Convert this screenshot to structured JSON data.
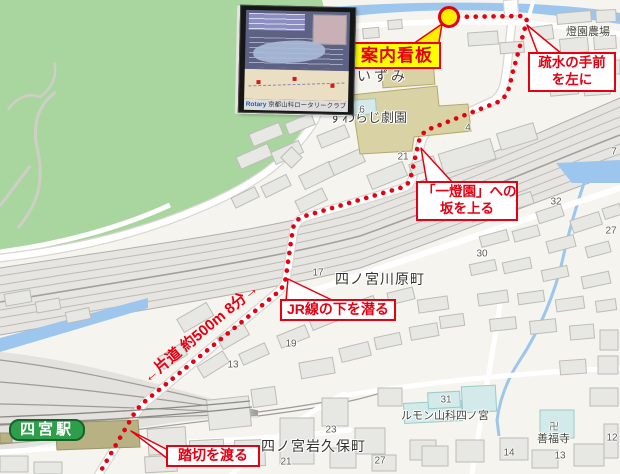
{
  "map": {
    "callouts": {
      "annai_kanban": "案内看板",
      "sosui_line1": "疏水の手前",
      "sosui_line2": "を左に",
      "itoen_line1": "「一燈園」への",
      "itoen_line2": "坂を上る",
      "jr_underpass": "JR線の下を潜る",
      "fumikiri": "踏切を渡る",
      "distance": "←片道 約500m 8分→"
    },
    "station": {
      "name": "四宮駅"
    },
    "places": {
      "izumi": "いずみ",
      "suwaraji": "すわらじ劇園",
      "kawaramachi": "四ノ宮川原町",
      "iwakubocho": "四ノ宮岩久保町",
      "lumon": "ルモン山科四ノ宮",
      "zenpukuji": "善福寺",
      "temple_mark": "卍",
      "toen_farm": "燈園農場"
    },
    "house_numbers": [
      {
        "v": "6",
        "x": 362,
        "y": 110
      },
      {
        "v": "21",
        "x": 403,
        "y": 157
      },
      {
        "v": "4",
        "x": 468,
        "y": 128
      },
      {
        "v": "7",
        "x": 614,
        "y": 152
      },
      {
        "v": "32",
        "x": 556,
        "y": 202
      },
      {
        "v": "27",
        "x": 611,
        "y": 231
      },
      {
        "v": "30",
        "x": 482,
        "y": 254
      },
      {
        "v": "17",
        "x": 318,
        "y": 273
      },
      {
        "v": "19",
        "x": 291,
        "y": 344
      },
      {
        "v": "13",
        "x": 233,
        "y": 365
      },
      {
        "v": "21",
        "x": 286,
        "y": 462
      },
      {
        "v": "23",
        "x": 331,
        "y": 430
      },
      {
        "v": "27",
        "x": 380,
        "y": 461
      },
      {
        "v": "31",
        "x": 446,
        "y": 400
      },
      {
        "v": "14",
        "x": 509,
        "y": 453
      },
      {
        "v": "13",
        "x": 560,
        "y": 456
      },
      {
        "v": "12",
        "x": 612,
        "y": 438
      }
    ],
    "inset": {
      "caption_logo": "Rotary",
      "caption_text": " 京都山科ロータリークラブ"
    },
    "colors": {
      "route_red": "#e60012",
      "marker_yellow": "#ffee00",
      "label_yellow": "#ffff00",
      "station_green": "#2f9e4b",
      "park_green": "#a9d69f",
      "water_blue": "#9cc6ee"
    }
  }
}
